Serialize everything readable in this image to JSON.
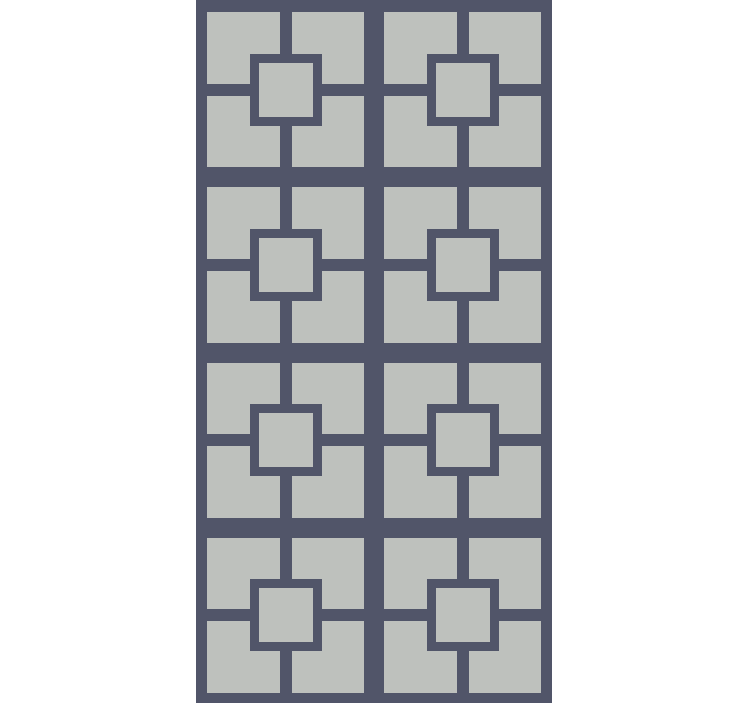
{
  "pattern": {
    "name": "geometric square lattice pattern",
    "description": "2x4 grid of identical square motifs; each motif has four light quadrant blocks separated by a dark cross, with a dark-outlined light center square overlapping the inner corners",
    "grid": {
      "columns": 2,
      "rows": 4,
      "tile_count": 8
    },
    "colors": {
      "canvas_background": "#ffffff",
      "lattice_dark": "#515569",
      "block_light": "#bec1bd"
    },
    "motif": {
      "quadrants_per_tile": 4,
      "has_center_ring": true,
      "has_center_square": true
    }
  }
}
